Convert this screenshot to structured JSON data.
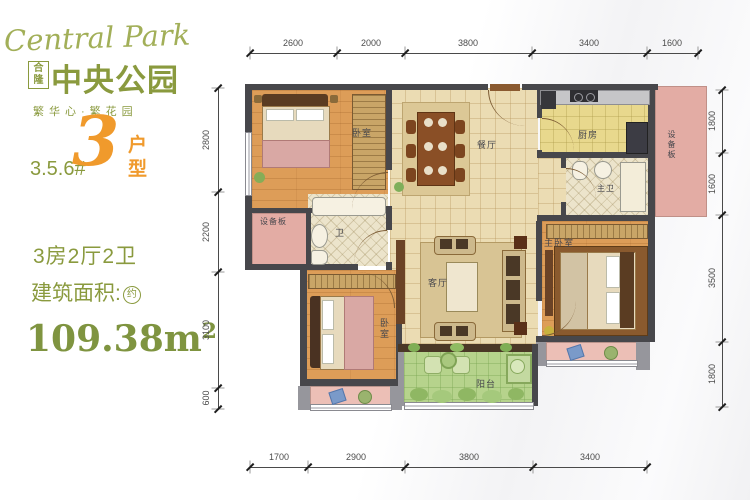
{
  "brand": {
    "logo_script": "Central Park",
    "logo_prefix": "合隆",
    "logo_name": "中央公园",
    "slogan": "繁华心·繁花园",
    "accent_green": "#8a9a3e",
    "accent_orange": "#f09a2c"
  },
  "unit": {
    "buildings": "3.5.6#",
    "number": "3",
    "type_suffix": "户型",
    "layout": "3房2厅2卫",
    "area_label": "建筑面积:",
    "area_approx": "约",
    "area_value": "109.38m",
    "area_sup": "2"
  },
  "rooms": {
    "bedroom_top": "卧室",
    "bedroom_bottom": "卧室",
    "master_bedroom": "主卧室",
    "living": "客厅",
    "dining": "餐厅",
    "kitchen": "厨房",
    "bath": "卫",
    "master_bath": "主卫",
    "balcony": "阳台",
    "equipment_left": "设备板",
    "equipment_right": "设备板"
  },
  "dimensions": {
    "top": [
      "2600",
      "2000",
      "3800",
      "3400",
      "1600"
    ],
    "bottom": [
      "1700",
      "2900",
      "3800",
      "3400"
    ],
    "left": [
      "2800",
      "2200",
      "3100",
      "600"
    ],
    "right": [
      "1800",
      "1600",
      "3500",
      "1800"
    ]
  }
}
